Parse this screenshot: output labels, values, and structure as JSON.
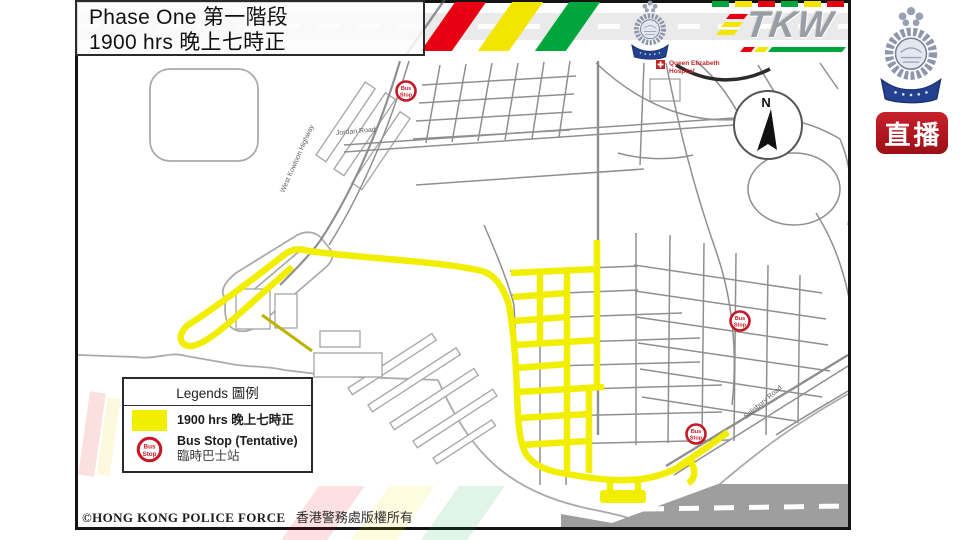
{
  "header": {
    "title_line1": "Phase One 第一階段",
    "title_line2": "1900 hrs 晚上七時正",
    "tkw_logo_text": "TKW",
    "stripe_colors": {
      "red": "#e60012",
      "yellow": "#f2e500",
      "green": "#00a63c"
    }
  },
  "sidebar": {
    "live_badge_label": "直播",
    "live_badge_color": "#ae1117"
  },
  "map": {
    "copyright_en": "©HONG KONG POLICE FORCE",
    "copyright_zh": "香港警務處版權所有",
    "compass_north_label": "N",
    "highlight_color": "#f2ee00",
    "labels": {
      "west_kowloon_highway": "West Kowloon Highway",
      "jordan_road": "Jordan Road",
      "salisbury_road": "Salisbury Road",
      "hospital_line1": "Queen Elizabeth",
      "hospital_line2": "Hospital"
    },
    "bus_stop_icon": {
      "line1": "Bus",
      "line2": "Stop"
    }
  },
  "legend": {
    "title": "Legends 圖例",
    "phase_label": "1900 hrs 晚上七時正",
    "phase_swatch_color": "#f2ee00",
    "bus_label_line1": "Bus Stop (Tentative)",
    "bus_label_line2": "臨時巴士站"
  }
}
